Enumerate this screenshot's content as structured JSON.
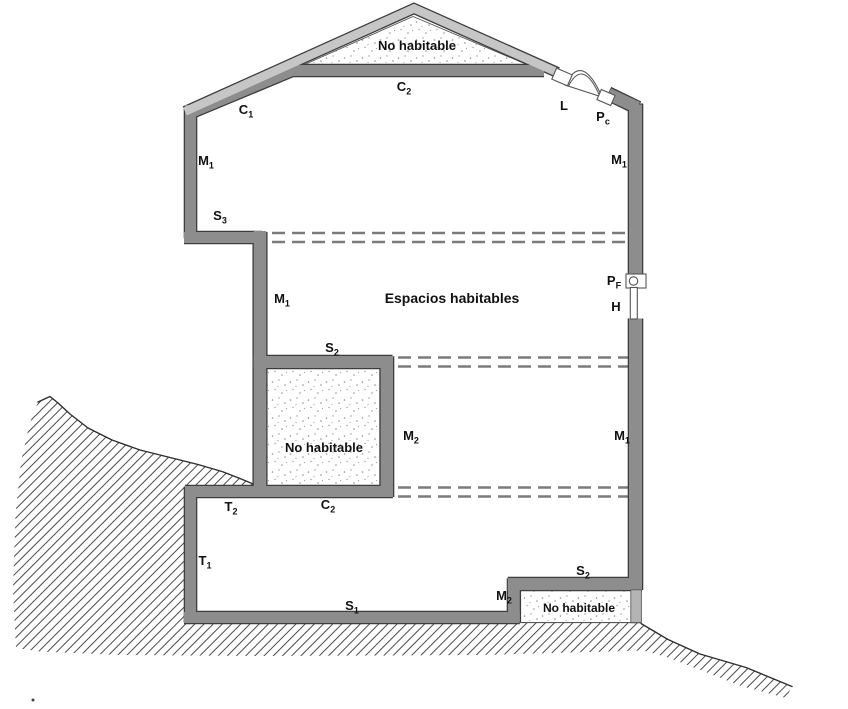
{
  "figure": {
    "type": "building-section-thermal-envelope-diagram",
    "space_labels": {
      "attic": "No habitable",
      "main": "Espacios habitables",
      "left_box": "No habitable",
      "crawl": "No habitable"
    },
    "element_labels": {
      "c1": {
        "base": "C",
        "sub": "1"
      },
      "c2_attic": {
        "base": "C",
        "sub": "2"
      },
      "c2_lower": {
        "base": "C",
        "sub": "2"
      },
      "m1_upper_left": {
        "base": "M",
        "sub": "1"
      },
      "m1_upper_right": {
        "base": "M",
        "sub": "1"
      },
      "m1_mid_left": {
        "base": "M",
        "sub": "1"
      },
      "m1_lower_right": {
        "base": "M",
        "sub": "1"
      },
      "m2_left_box": {
        "base": "M",
        "sub": "2"
      },
      "m2_bottom": {
        "base": "M",
        "sub": "2"
      },
      "s1": {
        "base": "S",
        "sub": "1"
      },
      "s2_mid": {
        "base": "S",
        "sub": "2"
      },
      "s2_bottom_right": {
        "base": "S",
        "sub": "2"
      },
      "s3": {
        "base": "S",
        "sub": "3"
      },
      "t1": {
        "base": "T",
        "sub": "1"
      },
      "t2": {
        "base": "T",
        "sub": "2"
      },
      "skylight": {
        "base": "L",
        "sub": ""
      },
      "pc": {
        "base": "P",
        "sub": "c"
      },
      "pf": {
        "base": "P",
        "sub": "F"
      },
      "window": {
        "base": "H",
        "sub": ""
      }
    },
    "colors": {
      "wall": "#8d8d8d",
      "wall-outline": "#3d3d3d",
      "roof-light": "#c6c6c6",
      "secondary-wall": "#b4b4b4",
      "dash": "#7b7b7b",
      "hatch": "#4a4a4a",
      "stipple": "#999999",
      "label": "#111111",
      "bg": "#ffffff"
    }
  }
}
